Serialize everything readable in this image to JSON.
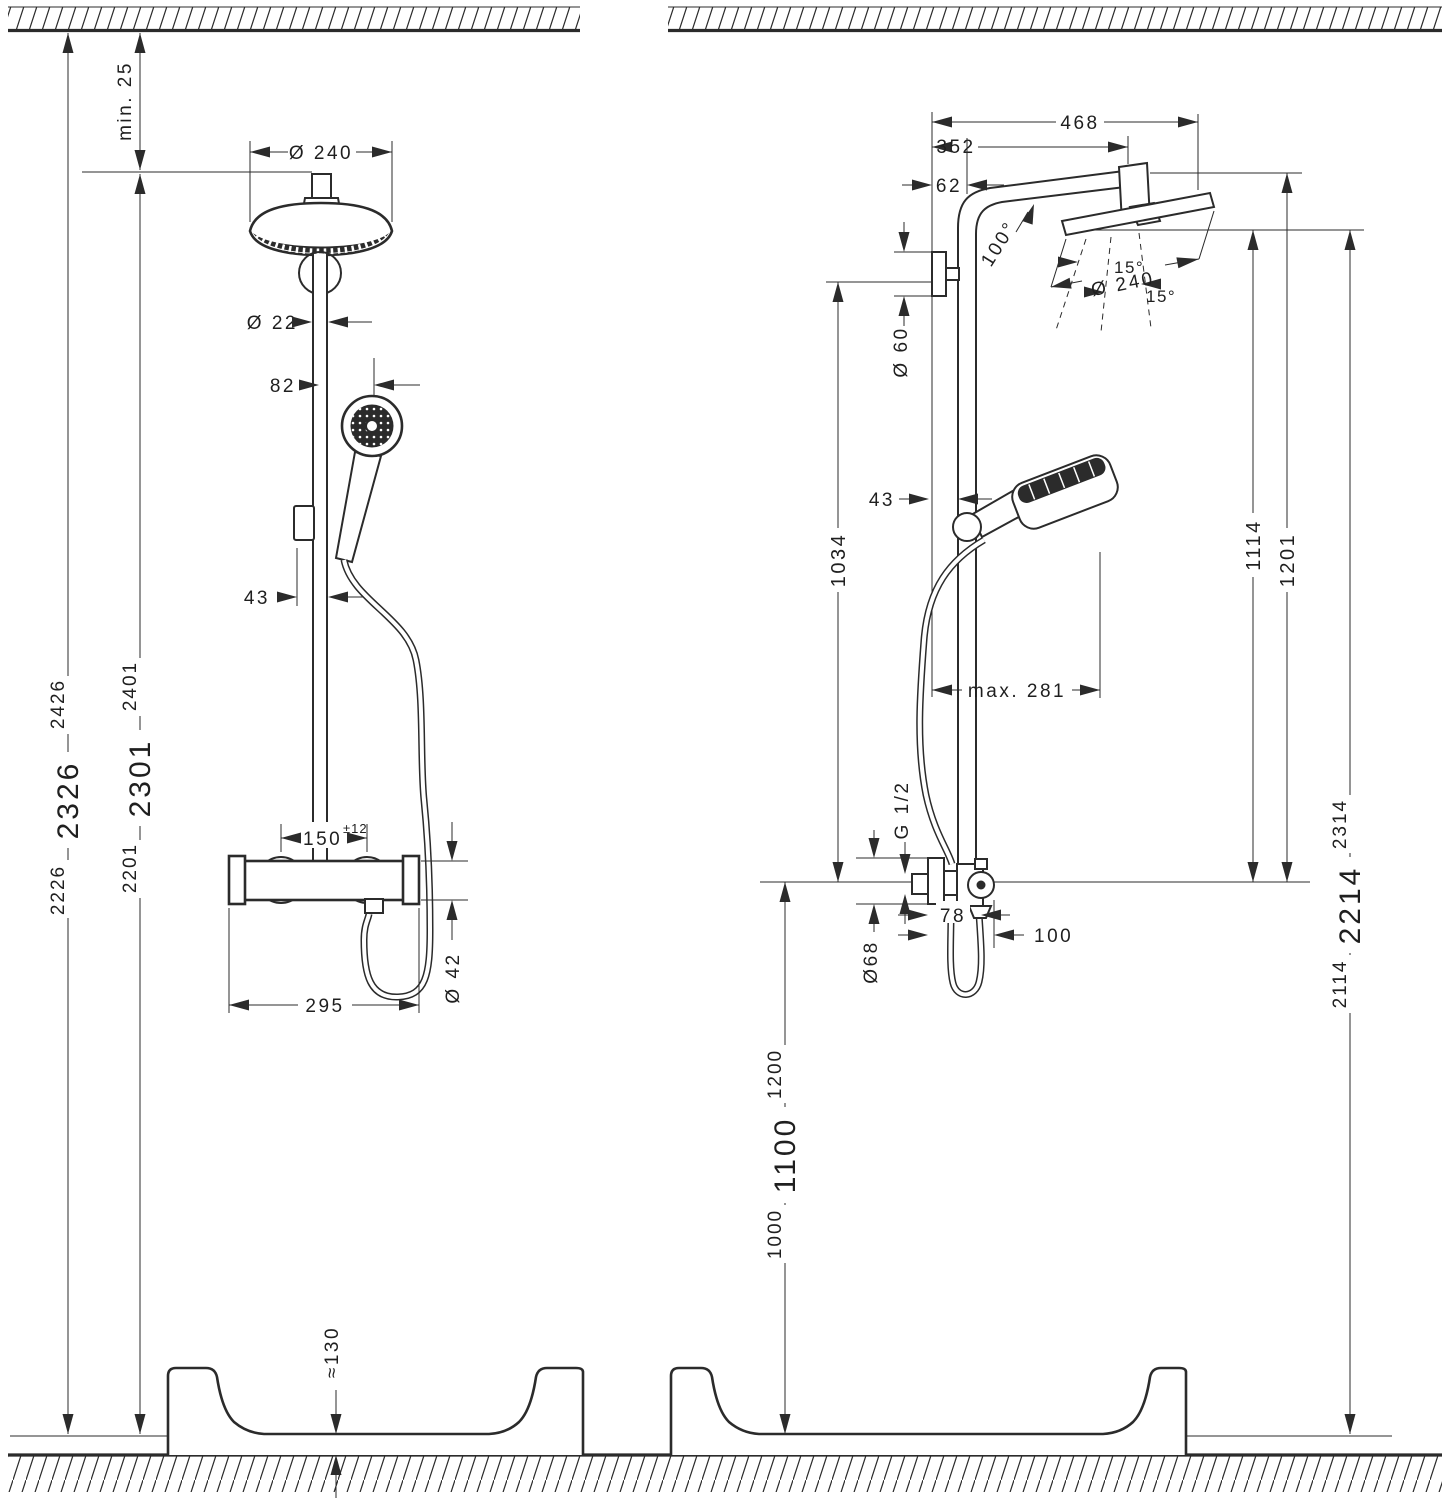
{
  "front_view": {
    "min_gap": "min. 25",
    "head_diameter": "Ø 240",
    "pipe_diameter": "Ø 22",
    "handshower_offset": "82",
    "holder_offset": "43",
    "total_height": {
      "main": "2326",
      "sup": "2426",
      "sub": "2226"
    },
    "body_height": {
      "main": "2301",
      "sup": "2401",
      "sub": "2201"
    },
    "valve_centers": {
      "main": "150",
      "sup": "±12"
    },
    "valve_diameter": "Ø 42",
    "valve_width": "295",
    "tray_height": "≈130"
  },
  "side_view": {
    "projection_total": "468",
    "projection_arm": "352",
    "wall_offset": "62",
    "arm_angle": "100°",
    "spray_angle_left": "15°",
    "spray_angle_right": "15°",
    "head_diameter": "Ø 240",
    "bracket_diameter": "Ø 60",
    "max_reach": "max. 281",
    "holder_offset": "43",
    "bracket_to_valve": "1034",
    "head_to_valve": "1114",
    "arm_to_valve": "1201",
    "thread": "G 1/2",
    "escutcheon_diameter": "Ø68",
    "axis_depth": "78",
    "front_depth": "100",
    "valve_height": {
      "main": "1100",
      "sup": "1200",
      "sub": "1000"
    },
    "head_height": {
      "main": "2214",
      "sup": "2314",
      "sub": "2114"
    }
  }
}
